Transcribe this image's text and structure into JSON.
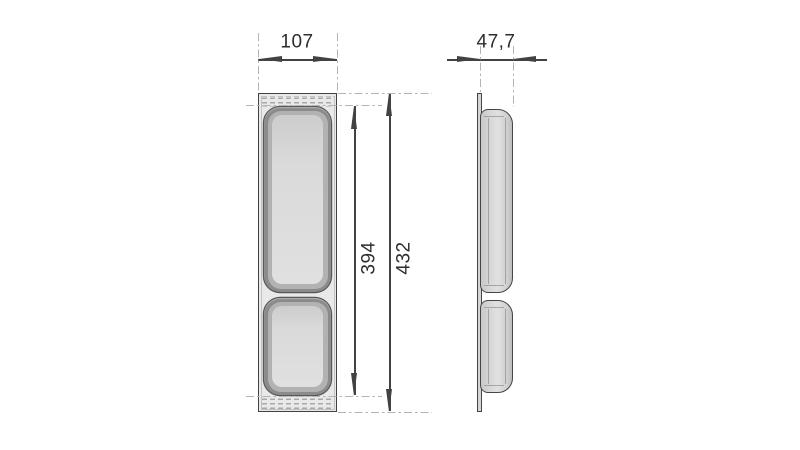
{
  "drawing": {
    "kind": "technical-dimension-drawing",
    "dims": {
      "front_width": "107",
      "front_inner_height": "394",
      "front_outer_height": "432",
      "side_depth": "47,7"
    },
    "colors": {
      "background": "#ffffff",
      "outline": "#424242",
      "extension_line": "#b4b4b4",
      "body_fill": "#e9e9e9",
      "recess_rim": "#8b8b8b",
      "recess_floor": "#dedede",
      "bulge_fill": "#d8d8d8",
      "label_text": "#2d2d2d"
    }
  }
}
